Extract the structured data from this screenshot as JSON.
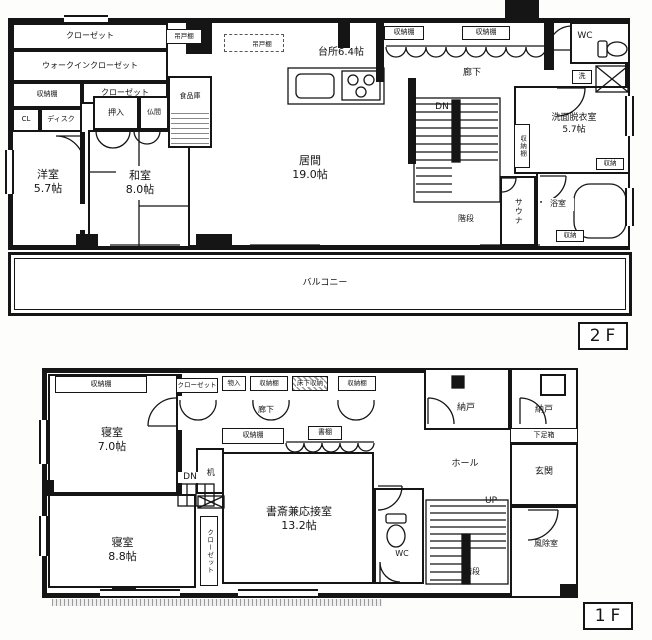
{
  "floor2": {
    "badge": "2F",
    "rooms": {
      "closet_top": "クローゼット",
      "walk_in": "ウォークインクローゼット",
      "shelf_left": "収納棚",
      "closet_mid": "クローゼット",
      "cl": "CL",
      "desk": "ディスク",
      "oshiire": "押入",
      "butsuma": "仏間",
      "pantry": "食品庫",
      "western": "洋室\n5.7帖",
      "japanese": "和室\n8.0帖",
      "living": "居間\n19.0帖",
      "kitchen": "台所6.4帖",
      "hang1": "吊戸棚",
      "hang2": "吊戸棚",
      "shelf_top1": "収納棚",
      "shelf_top2": "収納棚",
      "corridor": "廊下",
      "wc": "WC",
      "washer": "洗",
      "washroom": "洗面脱衣室\n5.7帖",
      "shelf_wash": "収納棚",
      "dn": "DN",
      "stairs": "階段",
      "sauna": "サウナ",
      "bath": "浴室",
      "sto1": "収納",
      "sto2": "収納",
      "balcony": "バルコニー"
    }
  },
  "floor1": {
    "badge": "1F",
    "rooms": {
      "shelf_bed7": "収納棚",
      "bed7": "寝室\n7.0帖",
      "closet_small": "クローゼット",
      "mono": "物入",
      "shelf_c1": "収納棚",
      "yukashita": "床下収納",
      "shelf_c2": "収納棚",
      "corridor": "廊下",
      "nando1": "納戸",
      "nando2": "納戸",
      "shoe": "下足箱",
      "hall": "ホール",
      "genkan": "玄関",
      "up": "UP",
      "stairs": "階段",
      "fujo": "風除室",
      "desk": "机",
      "shelf_study": "収納棚",
      "shodana": "書棚",
      "dn": "DN",
      "wc": "WC",
      "study": "書斎兼応接室\n13.2帖",
      "bed88": "寝室\n8.8帖",
      "closet_v": "クローゼット"
    }
  }
}
